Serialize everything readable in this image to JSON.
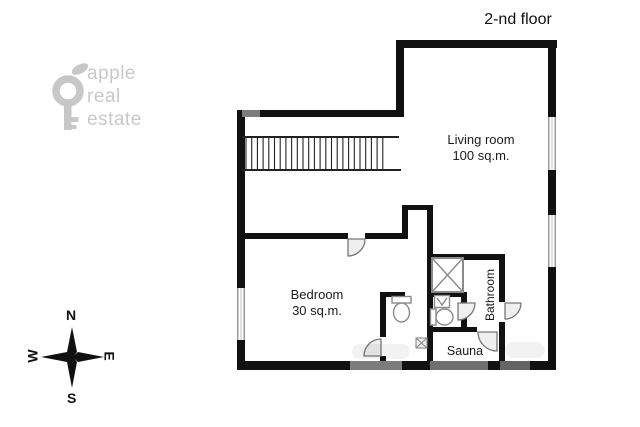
{
  "title": "2-nd floor",
  "logo": {
    "line1": "apple",
    "line2": "real",
    "line3": "estate"
  },
  "compass": {
    "north": "N",
    "south": "S",
    "west": "W",
    "east": "E"
  },
  "rooms": {
    "living_room": {
      "name": "Living room",
      "area": "100 sq.m."
    },
    "bedroom": {
      "name": "Bedroom",
      "area": "30 sq.m."
    },
    "bathroom": {
      "name": "Bathroom"
    },
    "sauna": {
      "name": "Sauna"
    }
  },
  "colors": {
    "wall": "#111111",
    "logo_gray": "#c7c7c7",
    "fixture_gray": "#8a8a8a",
    "door_fill": "#efefef",
    "window_edge": "#999999"
  },
  "icons": [
    "key-logo-icon",
    "leaf-icon",
    "compass-rose-icon",
    "shower-icon",
    "sink-icon",
    "toilet-icon",
    "stairs-icon",
    "door-arc-icon"
  ]
}
